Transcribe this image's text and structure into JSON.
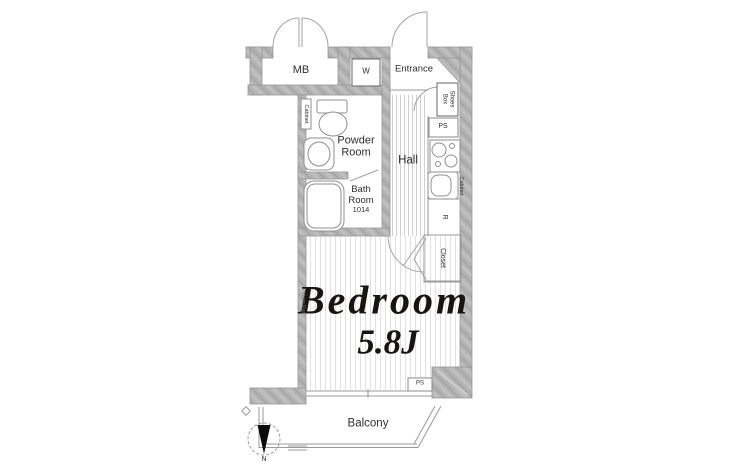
{
  "plan": {
    "labels": {
      "mb": "MB",
      "washer": "W",
      "entrance": "Entrance",
      "shoes_box": [
        "Shoes",
        "Box"
      ],
      "ps_upper": "PS",
      "ps_lower": "PS",
      "kitchen_cabinet": "Cabinet",
      "refrigerator": "R",
      "closet": "Closet",
      "powder_cabinet": "Cabinet",
      "powder_room": [
        "Powder",
        "Room"
      ],
      "bath_room": [
        "Bath",
        "Room"
      ],
      "bath_module": "1014",
      "hall": "Hall",
      "bedroom": "Bedroom",
      "bedroom_size": "5.8J",
      "picture_rail": "Picture Rail",
      "balcony": "Balcony",
      "north": "N"
    },
    "colors": {
      "wall": "#b4b4b4",
      "line": "#8f8f8f",
      "text": "#2f2f2f",
      "bedroom_text": "#181410"
    }
  }
}
